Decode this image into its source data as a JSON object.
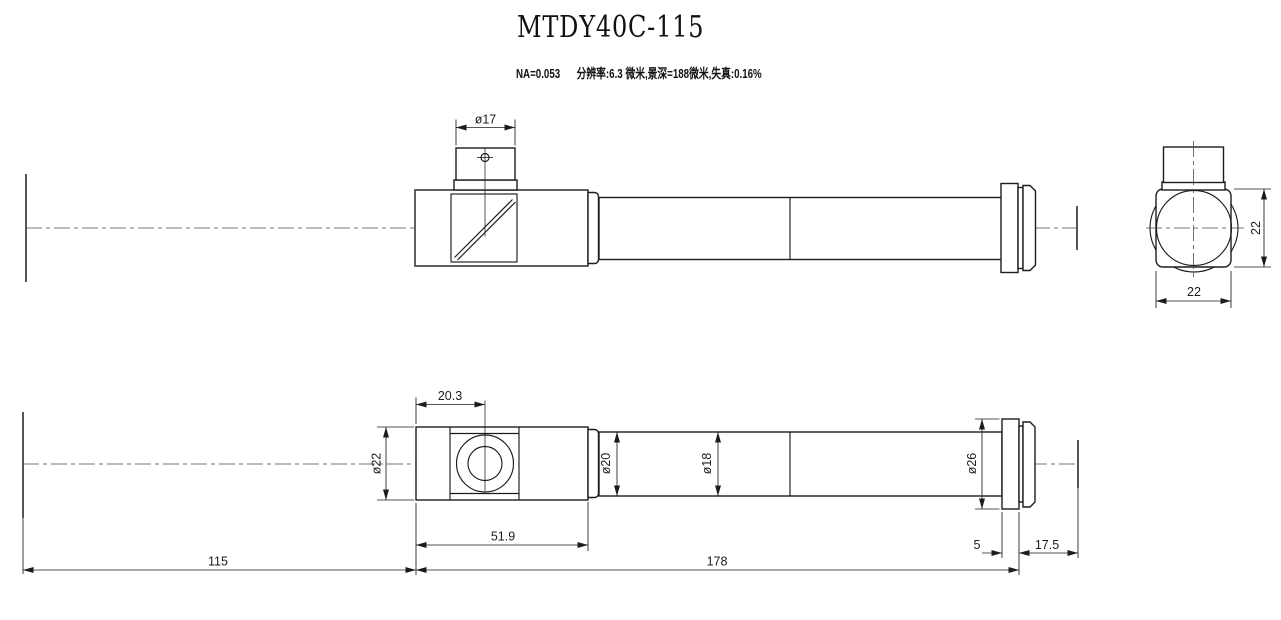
{
  "header": {
    "title": "MTDY40C-115",
    "spec_na": "NA=0.053",
    "spec_detail": "分辨率:6.3 微米,景深=188微米,失真:0.16%"
  },
  "side_view": {
    "dim_port_diameter": "ø17"
  },
  "end_view": {
    "dim_height": "22",
    "dim_width": "22"
  },
  "top_view": {
    "dim_port_offset": "20.3",
    "dim_body_diameter": "ø22",
    "dim_body_length": "51.9",
    "dim_neck_diameter": "ø20",
    "dim_tube_diameter": "ø18",
    "dim_flange_diameter": "ø26",
    "dim_flange_thickness": "5",
    "dim_working_distance": "17.5",
    "dim_front_length": "178",
    "dim_rear_length": "115"
  }
}
